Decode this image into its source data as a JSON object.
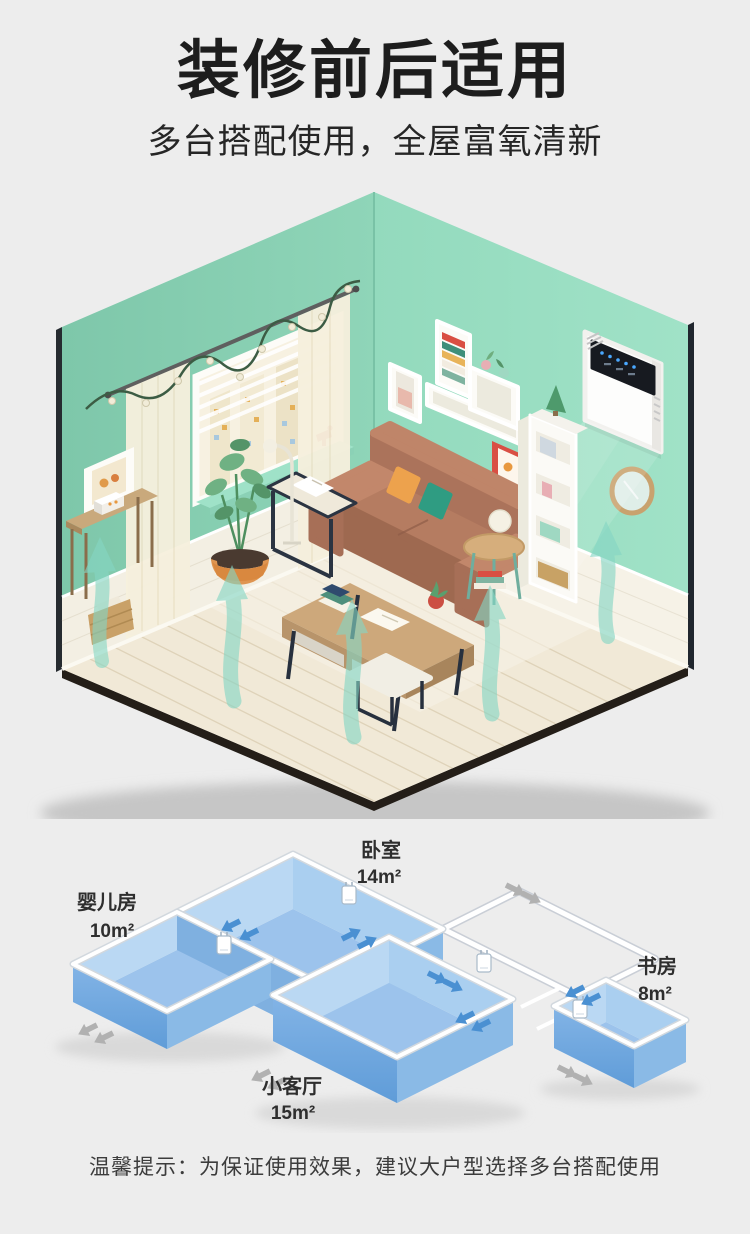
{
  "header": {
    "title": "装修前后适用",
    "subtitle": "多台搭配使用，全屋富氧清新"
  },
  "scene": {
    "device_icon": "wall-mounted-fresh-air-purifier",
    "airflow_icon": "fresh-air-up-arrows"
  },
  "floor_plan": {
    "rooms": [
      {
        "id": "nursery",
        "name": "婴儿房",
        "area": "10m²"
      },
      {
        "id": "bedroom",
        "name": "卧室",
        "area": "14m²"
      },
      {
        "id": "study",
        "name": "书房",
        "area": "8m²"
      },
      {
        "id": "living",
        "name": "小客厅",
        "area": "15m²"
      }
    ]
  },
  "footer": {
    "tip": "温馨提示：为保证使用效果，建议大户型选择多台搭配使用"
  },
  "colors": {
    "background": "#ededed",
    "wall_mint_left": "#86cfb2",
    "wall_mint_right": "#9adec2",
    "floor_cream": "#f1e9d7",
    "room_fill_blue": "#a9cdef",
    "flow_arrow_blue": "#4a90d2",
    "exhaust_arrow_gray": "#b1b1b1",
    "airflow_teal": "#85d6c4"
  }
}
